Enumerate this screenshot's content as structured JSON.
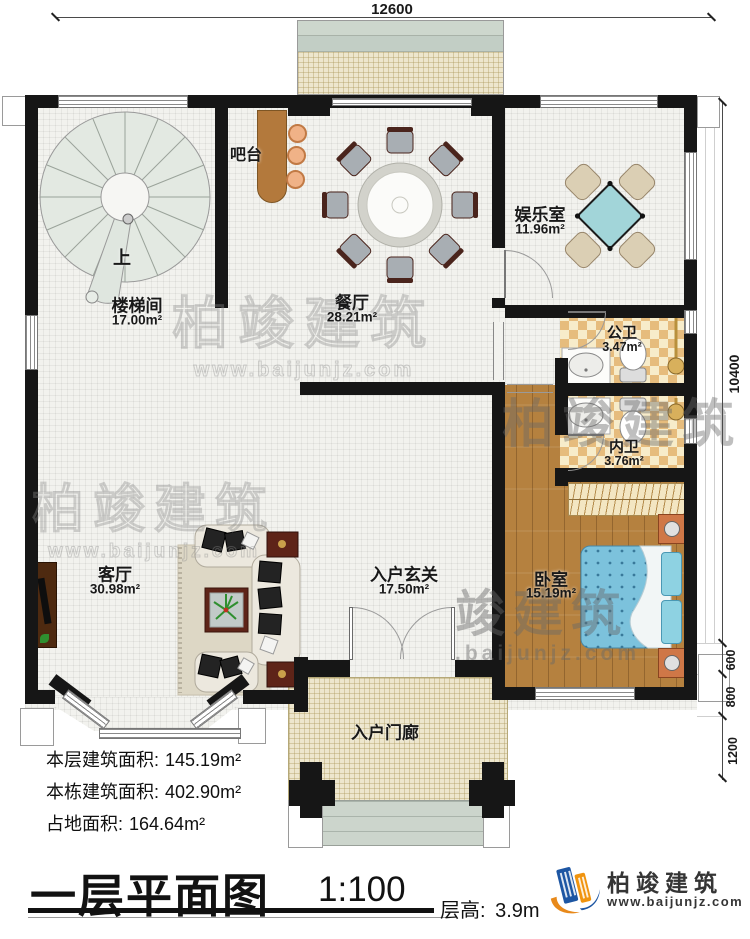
{
  "dimensions": {
    "top": "12600",
    "right_total": "10400",
    "right_segments": [
      "600",
      "800",
      "1200"
    ]
  },
  "rooms": {
    "stairwell": {
      "name": "楼梯间",
      "area": "17.00m²",
      "direction": "上"
    },
    "bar": {
      "name": "吧台"
    },
    "dining": {
      "name": "餐厅",
      "area": "28.21m²"
    },
    "entertainment": {
      "name": "娱乐室",
      "area": "11.96m²"
    },
    "public_bath": {
      "name": "公卫",
      "area": "3.47m²"
    },
    "private_bath": {
      "name": "内卫",
      "area": "3.76m²"
    },
    "living": {
      "name": "客厅",
      "area": "30.98m²"
    },
    "foyer": {
      "name": "入户玄关",
      "area": "17.50m²"
    },
    "bedroom": {
      "name": "卧室",
      "area": "15.19m²"
    },
    "porch": {
      "name": "入户门廊"
    }
  },
  "stats": [
    {
      "label": "本层建筑面积:",
      "value": "145.19m²"
    },
    {
      "label": "本栋建筑面积:",
      "value": "402.90m²"
    },
    {
      "label": "占地面积:",
      "value": "164.64m²"
    }
  ],
  "title_block": {
    "title": "一层平面图",
    "scale": "1:100",
    "floor_height_label": "层高:",
    "floor_height_value": "3.9m"
  },
  "brand": {
    "name": "柏竣建筑",
    "url": "www.baijunjz.com"
  },
  "watermark": {
    "name": "柏竣建筑",
    "name_partial": "竣建筑",
    "url": "www.baijunjz.com",
    "url_partial": ".baijunjz.com"
  },
  "colors": {
    "wall": "#161616",
    "wood_floor": "#b5813f",
    "bath_tile": "#e6bc7d",
    "bed_blue": "#7cc2dc",
    "mahjong_teal": "#a2d5d9",
    "bar_brown": "#b3793c",
    "terrace_green": "#c9d4ca",
    "brand_blue": "#1d56a3",
    "brand_orange": "#f0940f"
  }
}
